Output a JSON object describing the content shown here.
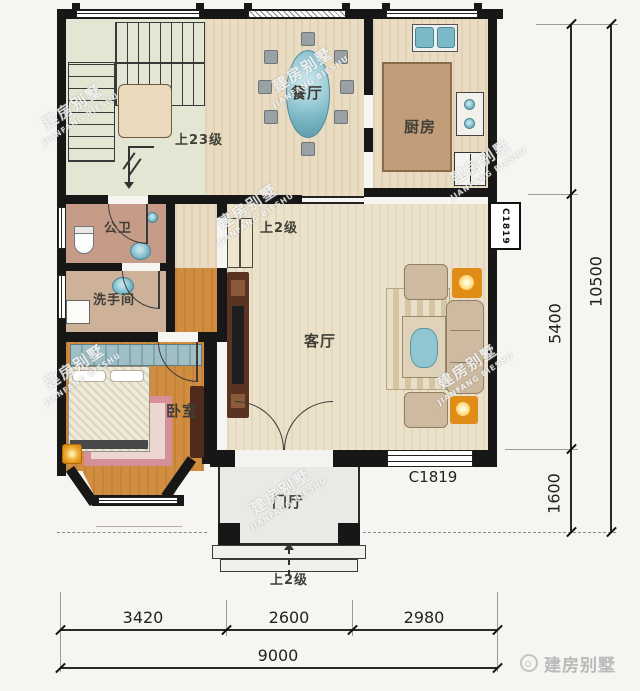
{
  "floor_plan": {
    "rooms": {
      "dining_room": "餐厅",
      "kitchen": "厨房",
      "public_bathroom": "公卫",
      "washroom": "洗手间",
      "bedroom": "卧室",
      "living_room": "客厅",
      "entrance_hall": "门厅"
    },
    "annotations": {
      "stair_up_label": "上23级",
      "interior_step_label": "上2级",
      "entrance_step_label": "上2级",
      "front_window_code": "C1819",
      "side_window_code": "C1819"
    },
    "dimensions": {
      "bottom_segments": [
        "3420",
        "2600",
        "2980"
      ],
      "bottom_total": "9000",
      "right_segments": [
        "5400",
        "1600"
      ],
      "right_total": "10500"
    },
    "watermark": {
      "cn": "建房别墅",
      "en": "JIANFANG BIESHU"
    },
    "logo_text": "建房别墅"
  },
  "colors": {
    "wall": "#171717",
    "wood_floor": "#e9dcc2",
    "bedroom_floor": "#d08d40",
    "stair_floor": "#e3e6d3",
    "fixture_teal": "#7bb9c8",
    "lamp_orange": "#e08d17",
    "rug_pink": "#d58f99"
  }
}
